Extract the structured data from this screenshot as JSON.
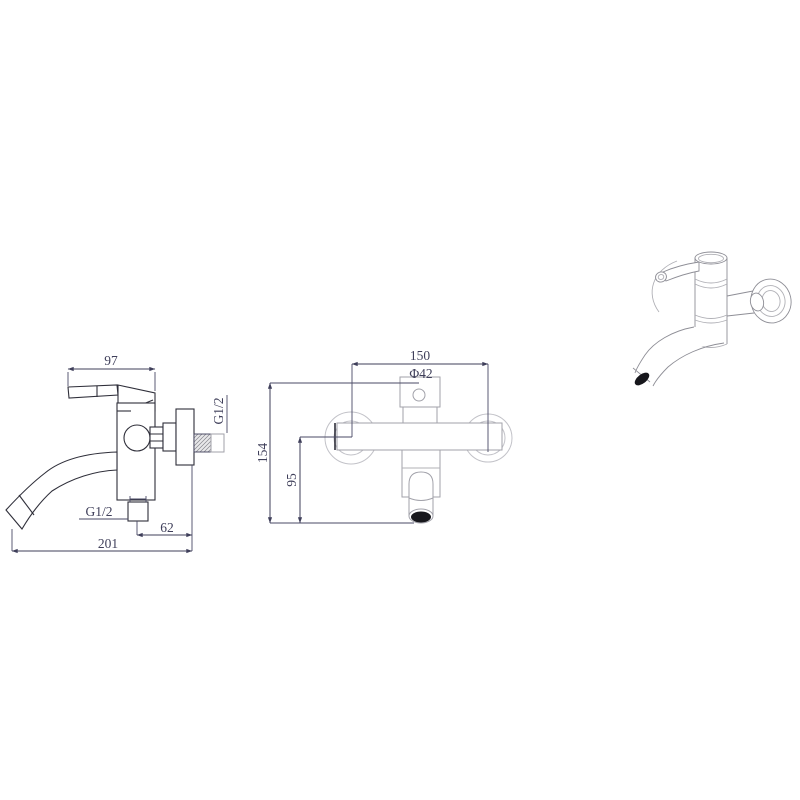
{
  "drawing": {
    "type": "faucet technical drawing, three views",
    "side_view": {
      "handle_length": "97",
      "wall_thread": "G1/2",
      "outlet_thread": "G1/2",
      "outlet_offset": "62",
      "overall_length": "201"
    },
    "front_view": {
      "center_distance": "150",
      "flange_diameter": "Φ42",
      "overall_height": "154",
      "spout_drop": "95"
    },
    "colors": {
      "dimension_ink": "#3f3f5a",
      "outline_dark": "#2f2f3a",
      "outline_light": "#a2a2aa",
      "aerator_tip": "#17171c",
      "background": "#ffffff"
    }
  }
}
